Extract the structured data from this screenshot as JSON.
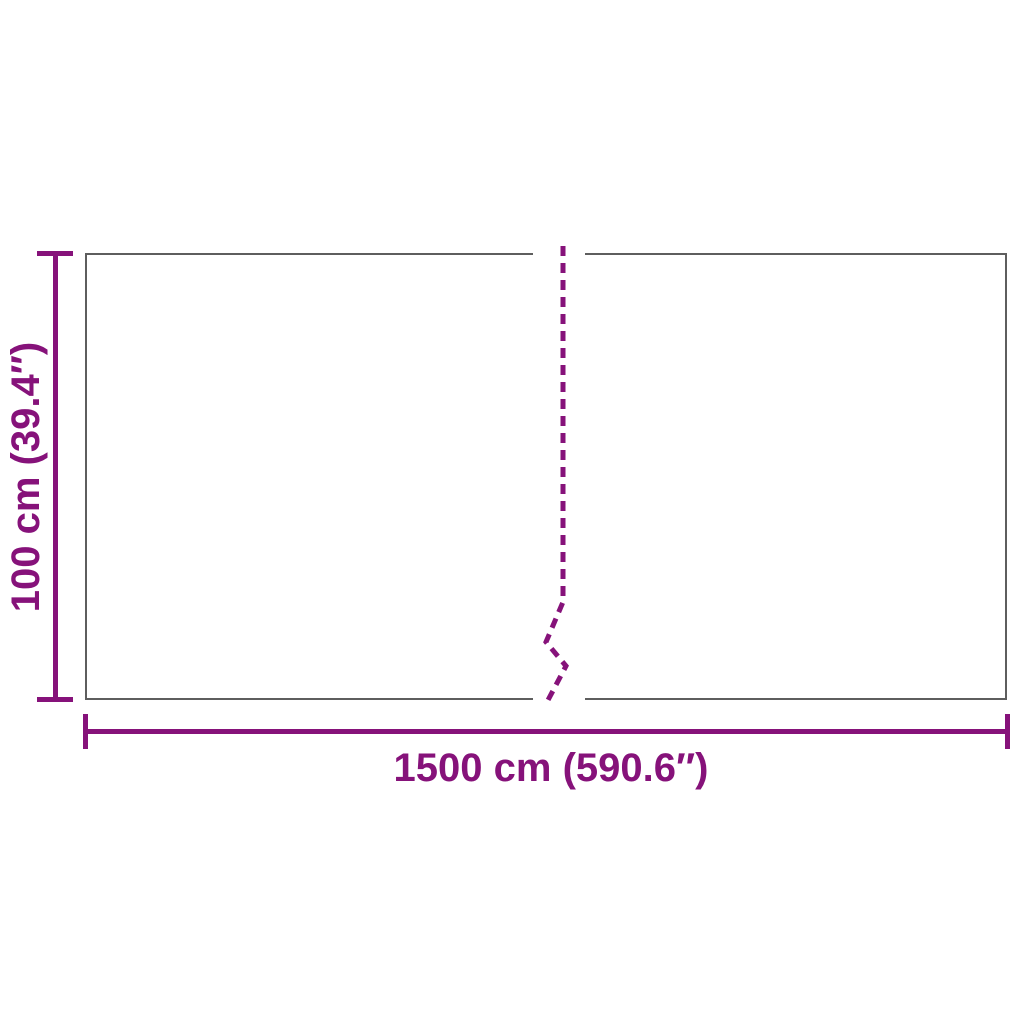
{
  "diagram": {
    "type": "product-dimension-diagram",
    "labels": {
      "height": "100 cm (39.4″)",
      "width": "1500 cm (590.6″)"
    },
    "colors": {
      "dimension": "#86127A",
      "panel_border": "#5E5E5E",
      "background": "#FFFFFF"
    },
    "fold_line": {
      "style": "dashed",
      "points": "563,246 563,602 546,642 566,666 547,702",
      "dash_pattern": "10 7",
      "stroke_width": "5"
    }
  }
}
